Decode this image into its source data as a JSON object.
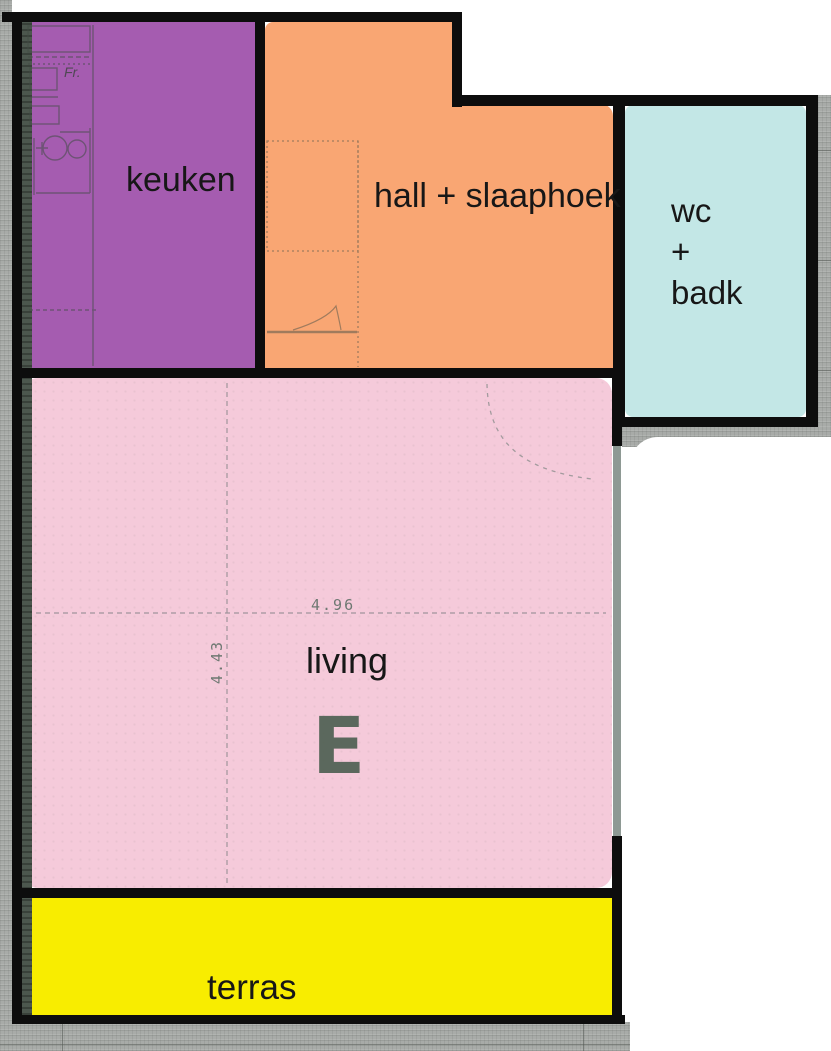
{
  "plan": {
    "rooms": {
      "keuken": {
        "label": "keuken",
        "color": "#a55cb0"
      },
      "hall": {
        "label": "hall + slaaphoek",
        "color": "#f9a673"
      },
      "wc_badk": {
        "line1": "wc",
        "line2": "+",
        "line3": "badk",
        "color": "#c3e7e6"
      },
      "living": {
        "label": "living",
        "color": "#f5cada",
        "unit_letter": "E"
      },
      "terras": {
        "label": "terras",
        "color": "#f8ed00"
      }
    },
    "dimensions": {
      "living_width": "4.96",
      "living_height": "4.43"
    },
    "sketch_labels": {
      "fridge": "Fr."
    },
    "colors": {
      "wall": "#0d0d0d",
      "exterior_gray": "#a8aba8",
      "inner_shadow": "#4c574e",
      "unit_letter": "#4f6053"
    }
  }
}
